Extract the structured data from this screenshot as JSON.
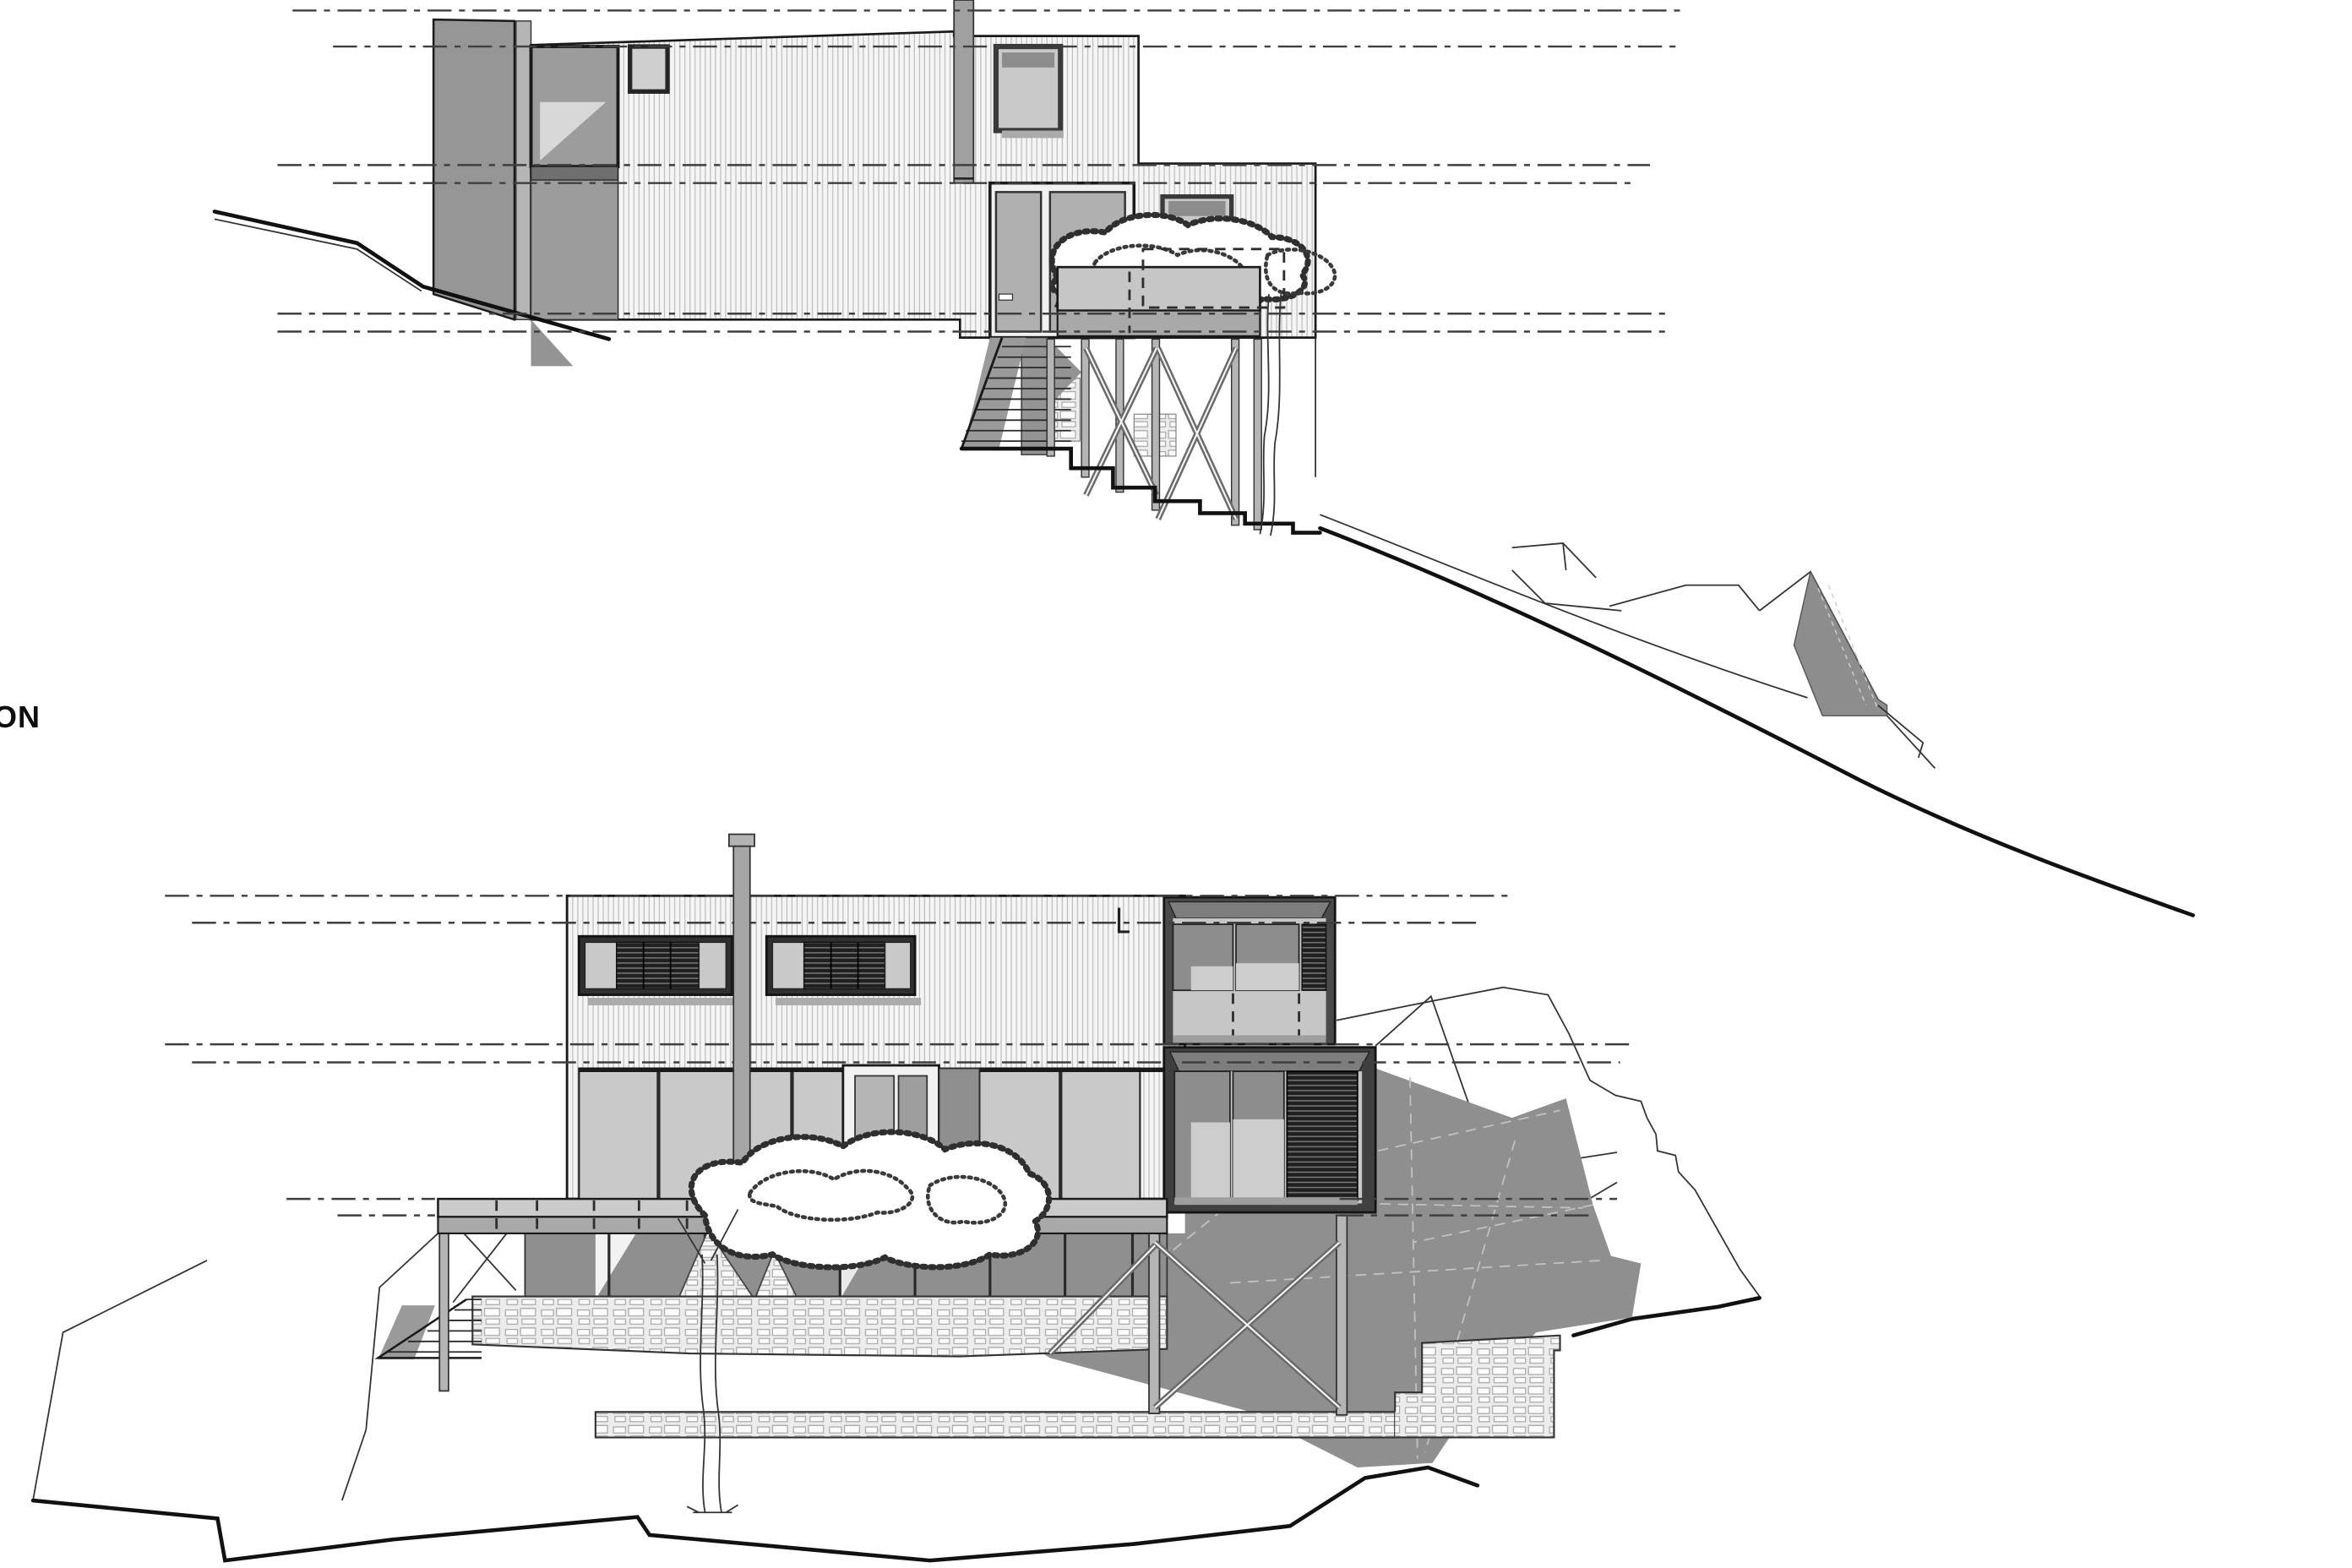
{
  "label": {
    "text": "ON"
  },
  "palette": {
    "background": "#ffffff",
    "line": "#1a1a1a",
    "datum_line": "#3f3f3f",
    "siding_hatch": "#bdbdbd",
    "wall_gray": "#969696",
    "glass_light": "#c9c9c9",
    "glass_mid": "#9c9c9c",
    "louver_dark": "#202020",
    "deck_gray": "#c6c6c6",
    "shadow_gray": "#8f8f8f",
    "stone_light": "#efefef"
  }
}
